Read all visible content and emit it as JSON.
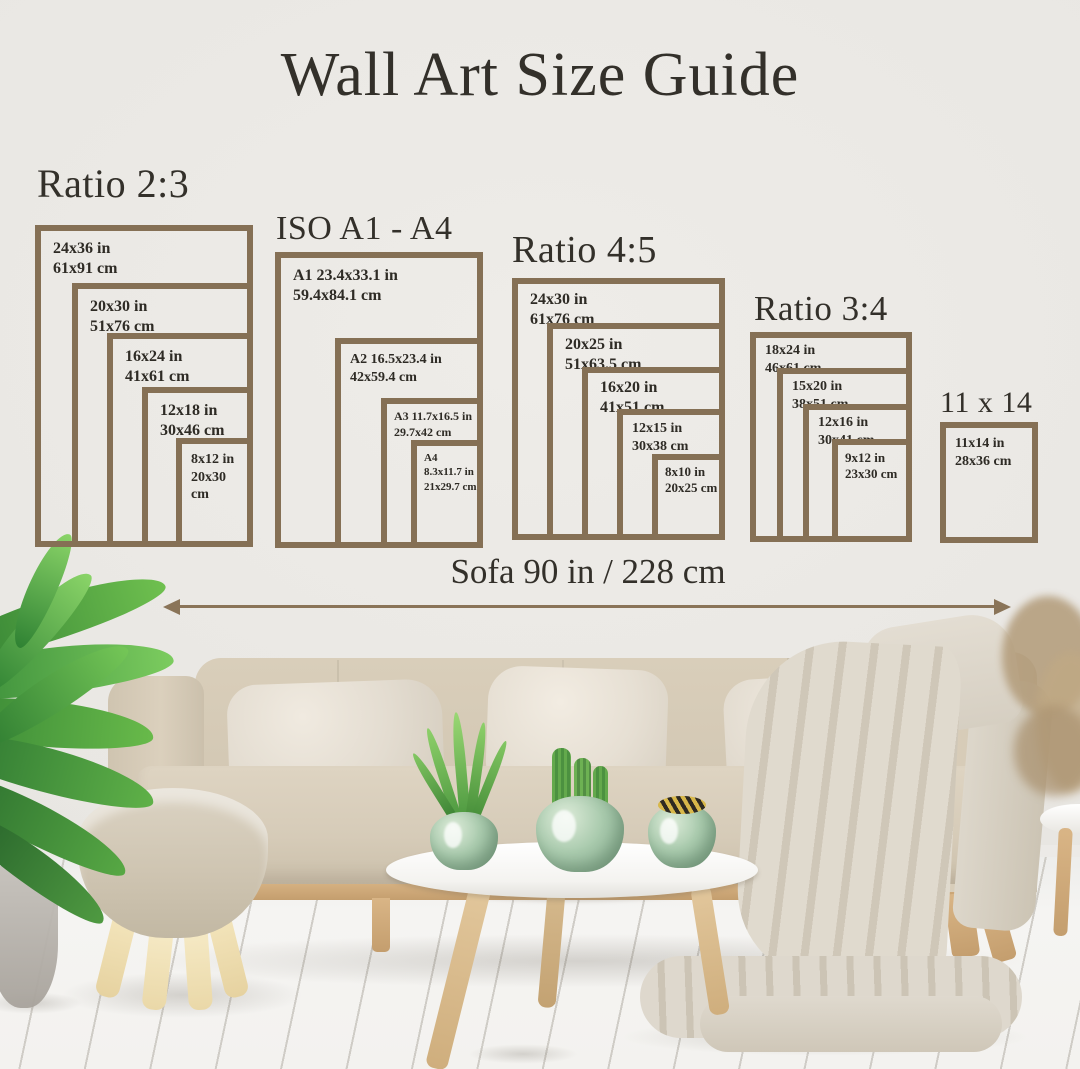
{
  "title": "Wall Art Size Guide",
  "groups": [
    {
      "heading": "Ratio 2:3",
      "frames": [
        {
          "size_in": "24x36 in",
          "size_cm": "61x91 cm"
        },
        {
          "size_in": "20x30 in",
          "size_cm": "51x76 cm"
        },
        {
          "size_in": "16x24 in",
          "size_cm": "41x61 cm"
        },
        {
          "size_in": "12x18 in",
          "size_cm": "30x46 cm"
        },
        {
          "size_in": "8x12 in",
          "size_cm": "20x30 cm"
        }
      ]
    },
    {
      "heading": "ISO A1 - A4",
      "frames": [
        {
          "size_in": "A1 23.4x33.1 in",
          "size_cm": "59.4x84.1 cm"
        },
        {
          "size_in": "A2 16.5x23.4 in",
          "size_cm": "42x59.4 cm"
        },
        {
          "size_in": "A3 11.7x16.5 in",
          "size_cm": "29.7x42 cm"
        },
        {
          "size_in": "A4 8.3x11.7 in",
          "size_cm": "21x29.7 cm"
        }
      ]
    },
    {
      "heading": "Ratio 4:5",
      "frames": [
        {
          "size_in": "24x30 in",
          "size_cm": "61x76 cm"
        },
        {
          "size_in": "20x25 in",
          "size_cm": "51x63.5 cm"
        },
        {
          "size_in": "16x20 in",
          "size_cm": "41x51 cm"
        },
        {
          "size_in": "12x15 in",
          "size_cm": "30x38 cm"
        },
        {
          "size_in": "8x10 in",
          "size_cm": "20x25 cm"
        }
      ]
    },
    {
      "heading": "Ratio 3:4",
      "frames": [
        {
          "size_in": "18x24 in",
          "size_cm": "46x61 cm"
        },
        {
          "size_in": "15x20 in",
          "size_cm": "38x51 cm"
        },
        {
          "size_in": "12x16 in",
          "size_cm": "30x41 cm"
        },
        {
          "size_in": "9x12 in",
          "size_cm": "23x30 cm"
        }
      ]
    },
    {
      "heading": "11 x 14",
      "frames": [
        {
          "size_in": "11x14 in",
          "size_cm": "28x36 cm"
        }
      ]
    }
  ],
  "sofa_measurement": {
    "label": "Sofa 90 in / 228 cm"
  },
  "colors": {
    "frame_border": "#857055",
    "arrow": "#8a7458",
    "text": "#33302a",
    "wall": "#e9e7e3",
    "sofa_fabric": "#d5cab7",
    "pillow": "#e8e2d7",
    "blanket": "#dcd6cb",
    "wood": "#cda671",
    "plant_green": "#5cb84e",
    "vase_green": "#a9cbad",
    "floor": "#f3f2ef"
  }
}
